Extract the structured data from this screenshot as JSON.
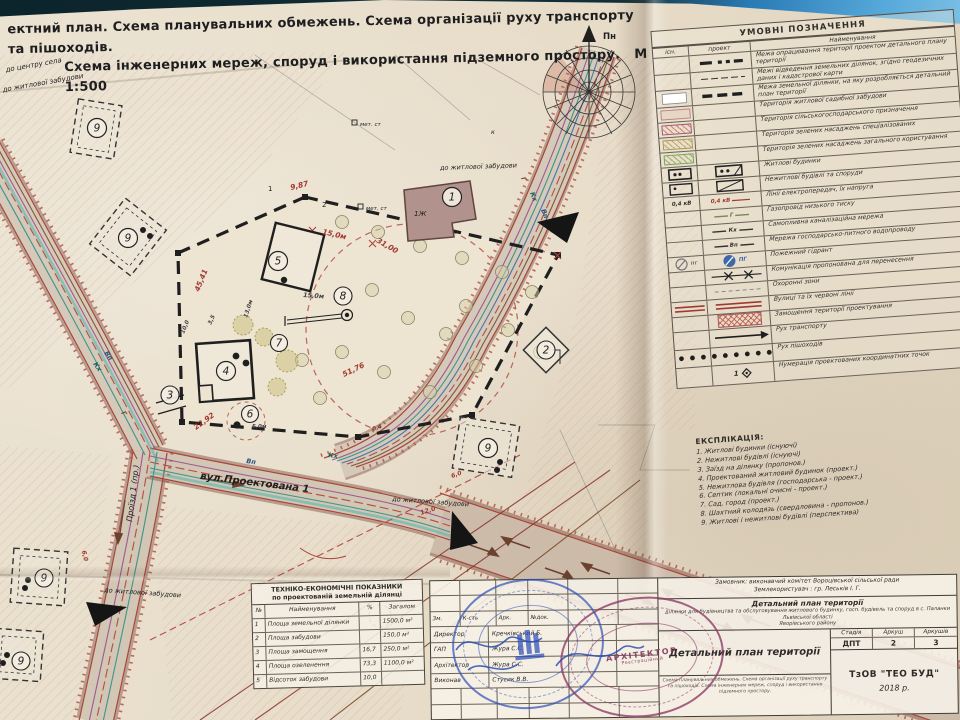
{
  "colors": {
    "paper": "#e8dfcd",
    "ink": "#2b2b2b",
    "red_line": "#a8453c",
    "water_teal": "#2e8f85",
    "stamp_blue": "#2c50b8",
    "stamp_purple": "#8c3a66"
  },
  "header": {
    "line1": "ектний план. Схема планувальних обмежень. Схема організації руху транспорту та пішоходів.",
    "line2": "Схема інженерних мереж, споруд і використання підземного простору.",
    "scale": "М 1:500"
  },
  "compass": {
    "north": "Пн"
  },
  "legend": {
    "title": "УМОВНІ ПОЗНАЧЕННЯ",
    "col_exist": "існ.",
    "col_project": "проект",
    "col_name": "Найменування",
    "rows": [
      {
        "name": "Межа опрацювання території проектом детального плану території"
      },
      {
        "name": "Межі відведення земельних ділянок, згідно геодезичних даних і кадастрової карти"
      },
      {
        "name": "Межа земельної ділянки, на яку розробляється детальний план території"
      },
      {
        "name": "Територія житлової садибної забудови"
      },
      {
        "name": "Територія сільськогосподарського призначення"
      },
      {
        "name": "Територія зелених насаджень спеціалізованих"
      },
      {
        "name": "Територія зелених насаджень загального користування"
      },
      {
        "name": "Житлові будинки"
      },
      {
        "name": "Нежитлові будівлі та споруди"
      },
      {
        "name": "Лінії електропередач, їх напруга",
        "exist_label": "0,4 кВ",
        "proj_label": "0,4 кВ"
      },
      {
        "name": "Газопровід низького тиску",
        "proj_label": "Г"
      },
      {
        "name": "Самопливна каналізаційна мережа",
        "proj_label": "Кх"
      },
      {
        "name": "Мережа господарсько-питного водопроводу",
        "proj_label": "Вп"
      },
      {
        "name": "Пожежний гідрант",
        "exist_label": "пг",
        "proj_label": "ПГ"
      },
      {
        "name": "Комунікація пропонована для перенесення"
      },
      {
        "name": "Охоронні зони"
      },
      {
        "name": "Вулиці та їх червоні лінії"
      },
      {
        "name": "Замощення території проектування"
      },
      {
        "name": "Рух транспорту"
      },
      {
        "name": "Рух пішоходів"
      },
      {
        "name": "Нумерація проектованих координатних точок",
        "proj_label": "1"
      }
    ]
  },
  "explication": {
    "title": "ЕКСПЛІКАЦІЯ:",
    "items": [
      "1. Житлові будинки (існуючі)",
      "2. Нежитлові будівлі (існуючі)",
      "3. Заїзд на ділянку (пропонов.)",
      "4. Проектований житловий будинок (проект.)",
      "5. Нежитлова будівля (господарська - проект.)",
      "6. Септик (локальні очисні - проект.)",
      "7. Сад, город (проект.)",
      "8. Шахтний колодязь (свердловина - пропонов.)",
      "9. Житлові і нежитлові будівлі (перспектива)"
    ]
  },
  "tep": {
    "title1": "ТЕХНІКО-ЕКОНОМІЧНІ ПОКАЗНИКИ",
    "title2": "по проектованій земельній ділянці",
    "col_no": "№",
    "col_name": "Найменування",
    "col_pct": "%",
    "col_total": "Загалом",
    "rows": [
      {
        "no": "1",
        "name": "Площа земельної ділянки",
        "pct": "",
        "total": "1500,0 м²"
      },
      {
        "no": "2",
        "name": "Площа забудови",
        "pct": "",
        "total": "150,0 м²"
      },
      {
        "no": "3",
        "name": "Площа замощення",
        "pct": "16,7",
        "total": "250,0 м²"
      },
      {
        "no": "4",
        "name": "Площа озеленення",
        "pct": "73,3",
        "total": "1100,0 м²"
      },
      {
        "no": "5",
        "name": "Відсоток забудови",
        "pct": "10,0",
        "total": ""
      }
    ]
  },
  "titleblock": {
    "customer": "Замовник: виконавчий комітет Вороцівської сільської ради",
    "landuser": "Землекористувач : гр. Леськів І. Г.",
    "doc_title": "Детальний план території",
    "doc_desc1": "ділянки для будівництва та обслуговування житлового будинку,",
    "doc_desc2": "госп. будівель та споруд в с. Паланки Львівської області",
    "doc_desc3": "Яворівського району",
    "col1": "Зм.",
    "col2": "К-сть",
    "col3": "Арк.",
    "col4": "№док.",
    "rows": [
      {
        "role": "Директор",
        "name": "Кречківський Б."
      },
      {
        "role": "ГАП",
        "name": "Жура С.С."
      },
      {
        "role": "Архітектор",
        "name": "Жура С.С."
      },
      {
        "role": "Виконав",
        "name": "Стусик В.В."
      }
    ],
    "sheet_title": "Детальний план території",
    "stage_label": "Стадія",
    "sheet_label": "Аркуш",
    "sheets_label": "Аркушів",
    "stage": "ДПТ",
    "sheet": "2",
    "sheets": "3",
    "content_note": "Схема планувальних обмежень. Схема організації руху транспорту та пішоходів. Схема інженерних мереж, споруд і використання підземного простору.",
    "company": "ТзОВ \"ТЕО БУД\"",
    "year": "2018 р.",
    "stamp_title": "АРХІТЕКТОР",
    "stamp_reg": "Реєстраційний"
  },
  "map": {
    "labels": {
      "to_center": "до центру села",
      "to_residential": "до житлової забудови",
      "street": "вул.Проектована 1",
      "driveway": "Проїзд 1 (пр.)",
      "met_st": "мет. ст",
      "one_zh": "1Ж",
      "k": "к"
    },
    "dims": {
      "d9_87": "9,87",
      "d31_00": "31,00",
      "d45_41": "45,41",
      "d51_76": "51,76",
      "d22_92": "22,92",
      "d15_0": "15,0м",
      "d5_0": "5,0м",
      "d6_0": "6,0",
      "d3_5": "3,5",
      "d13_0": "13,0м",
      "d12_0": "12,0",
      "d10_0": "10,0",
      "d0_4": "0,4"
    },
    "points": {
      "p1": "1",
      "p2": "2"
    },
    "markers": {
      "m1": "1",
      "m2": "2",
      "m3": "3",
      "m4": "4",
      "m5": "5",
      "m6": "6",
      "m7": "7",
      "m8": "8",
      "m9": "9"
    },
    "utilities": {
      "g": "Г",
      "kh": "Кх",
      "vp": "Вп"
    }
  }
}
